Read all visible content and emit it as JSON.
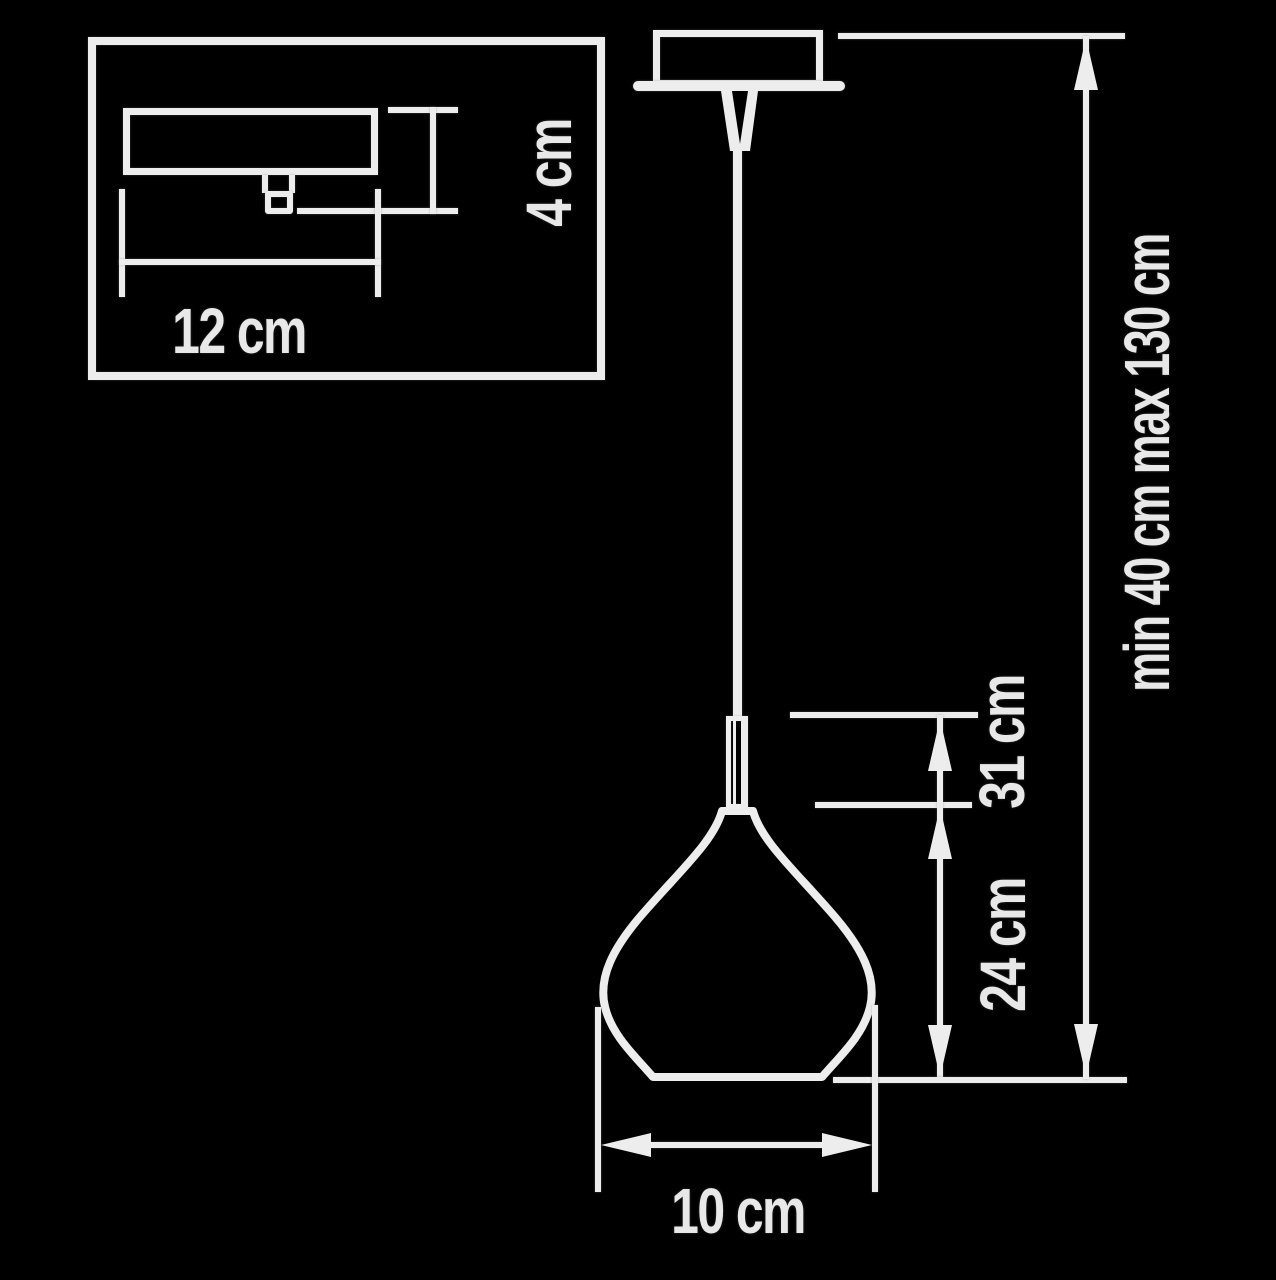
{
  "diagram": {
    "title_semantic": "pendant lamp dimension drawing",
    "colors": {
      "background": "#000000",
      "line": "#ededed",
      "text": "#e8e8e8"
    },
    "inset": {
      "canopy_width": "12 cm",
      "canopy_height": "4 cm"
    },
    "dimensions": {
      "shade_width": "10 cm",
      "shade_height": "24 cm",
      "body_height": "31 cm",
      "suspension_range": "min 40 cm max 130 cm"
    }
  }
}
